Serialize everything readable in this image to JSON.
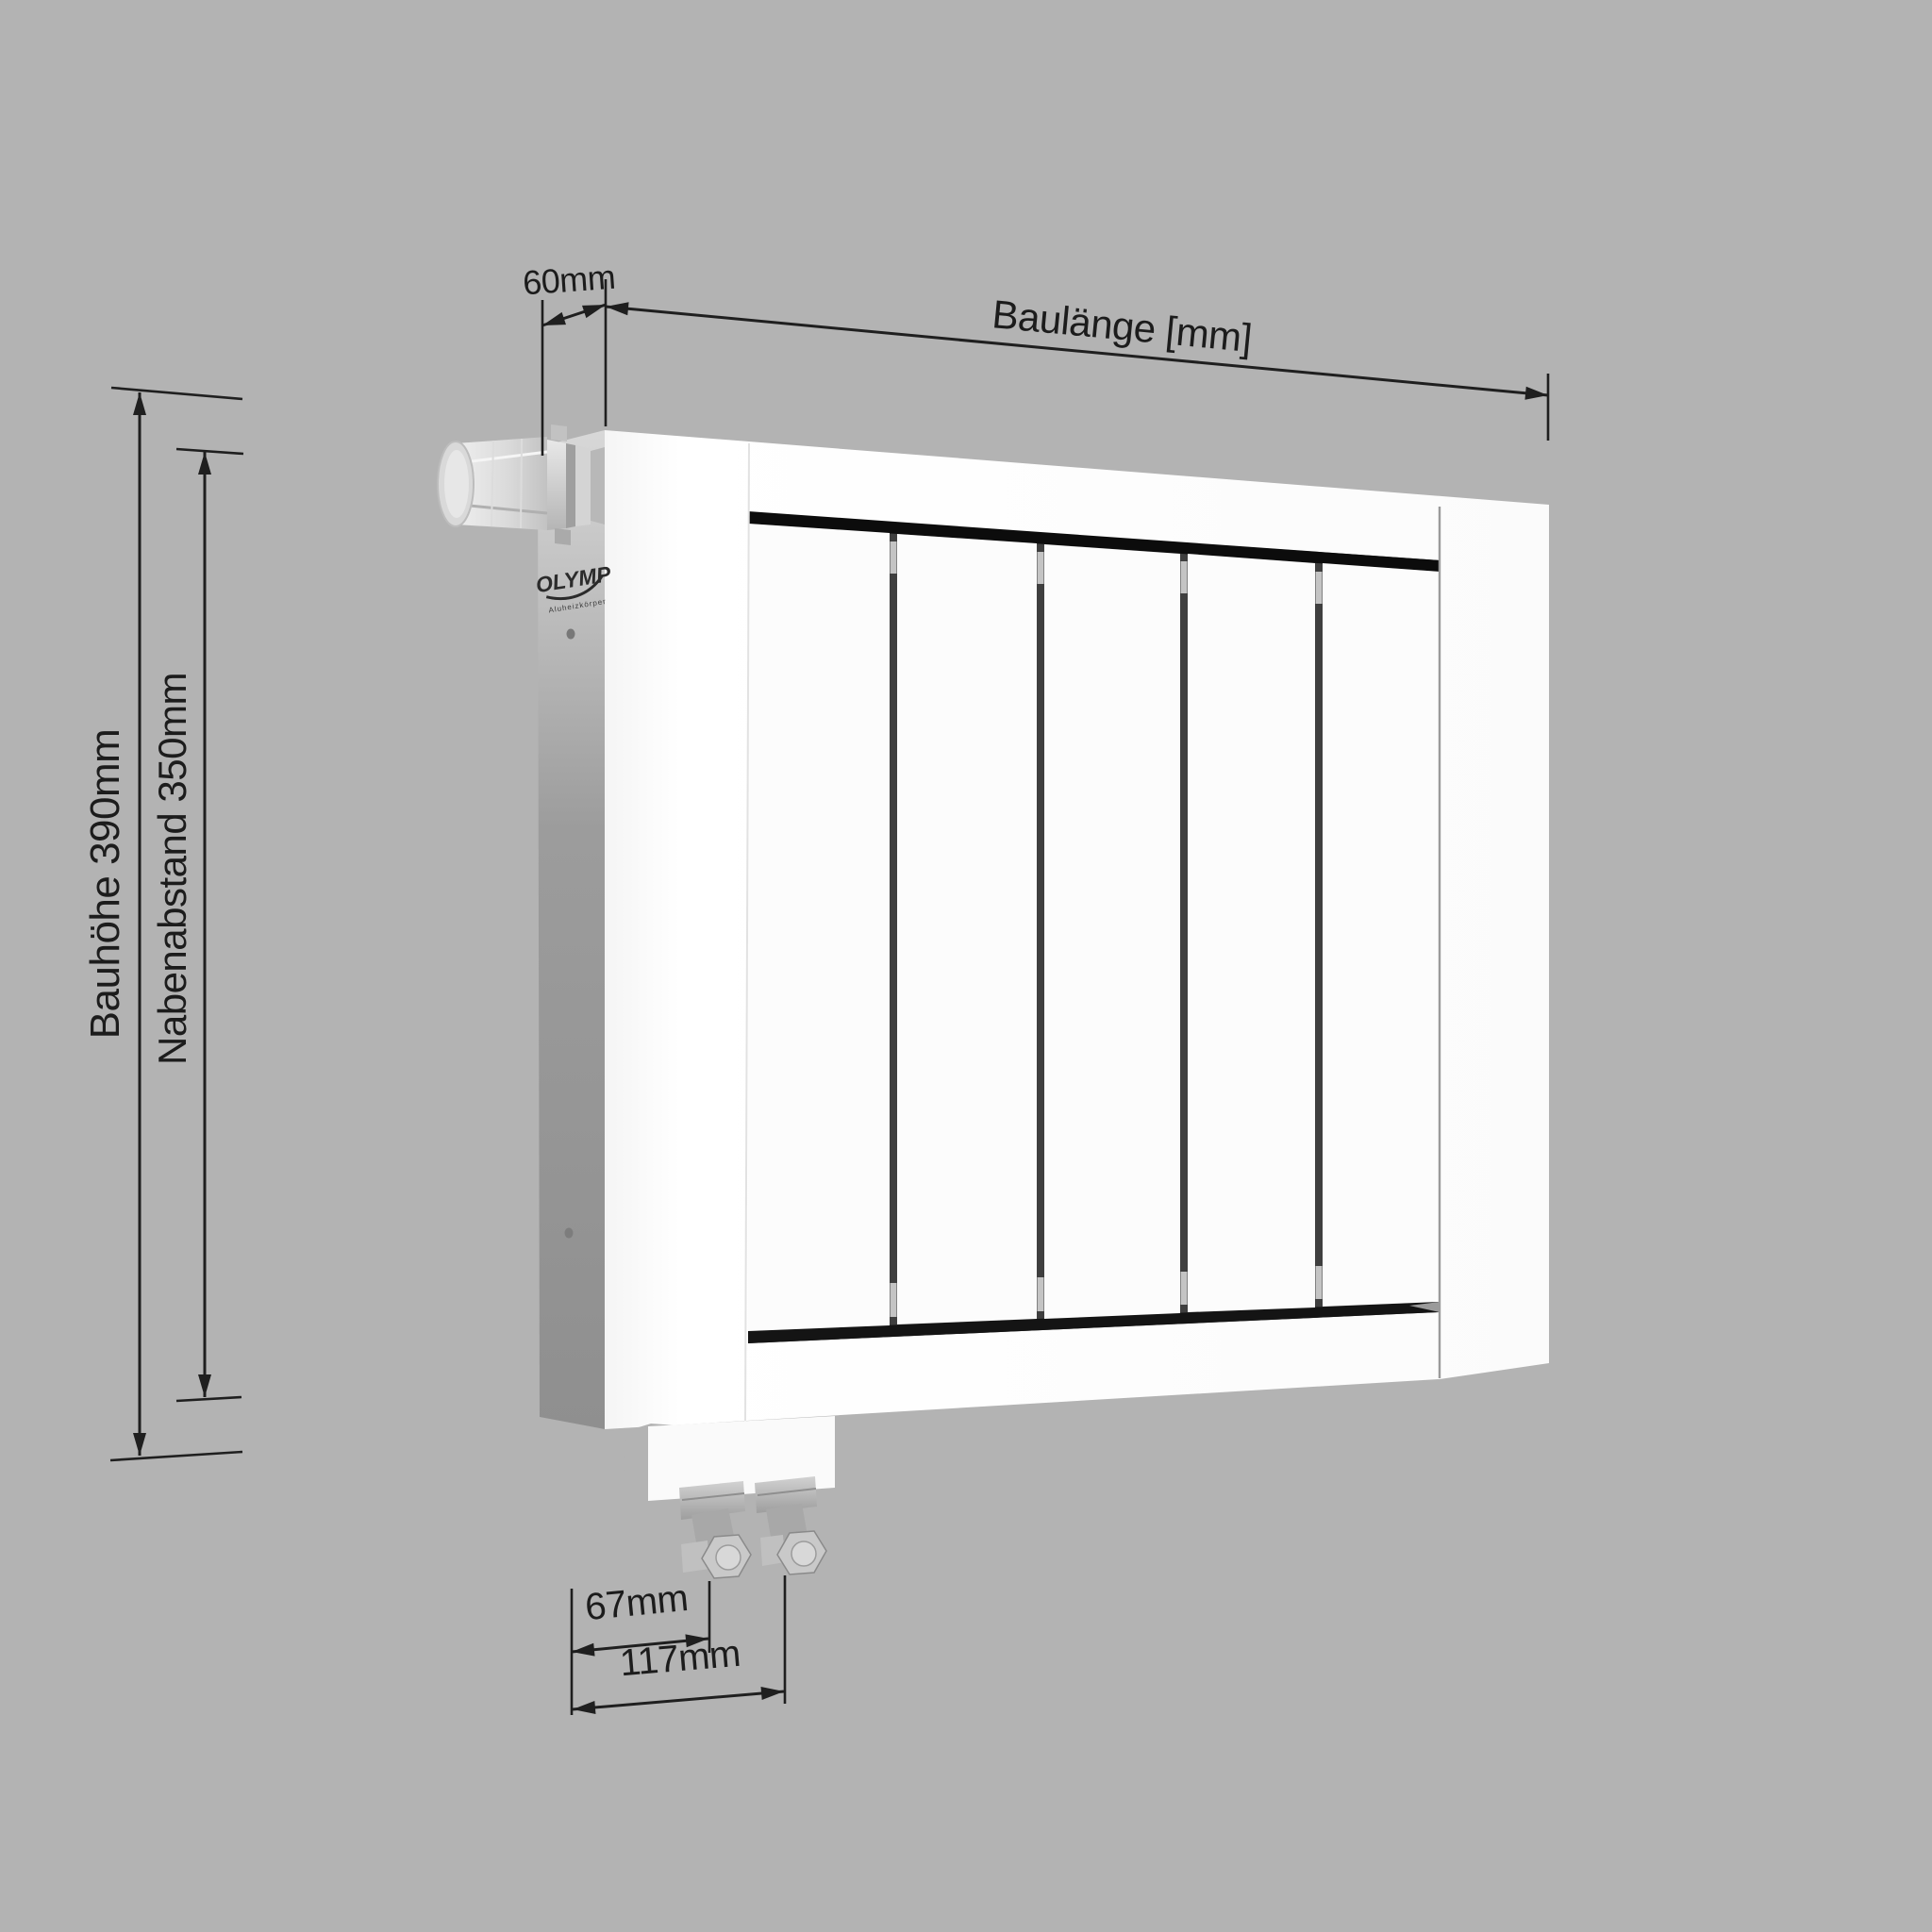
{
  "colors": {
    "background": "#b3b3b3",
    "line": "#1f1f1f",
    "text": "#1c1c1c",
    "radiator_front": "#fdfdfd",
    "radiator_side": "#989898",
    "inset": "#0d0d0d"
  },
  "radiator": {
    "sections": 5,
    "logo": {
      "brand": "OLYMP",
      "subtitle": "Aluheizkörper"
    }
  },
  "dimensions": {
    "depth": {
      "label": "60mm"
    },
    "length": {
      "label": "Baulänge [mm]"
    },
    "height": {
      "label": "Bauhöhe 390mm"
    },
    "hub_spacing": {
      "label": "Nabenabstand 350mm"
    },
    "valve_offset_inner": {
      "label": "67mm"
    },
    "valve_offset_outer": {
      "label": "117mm"
    }
  }
}
